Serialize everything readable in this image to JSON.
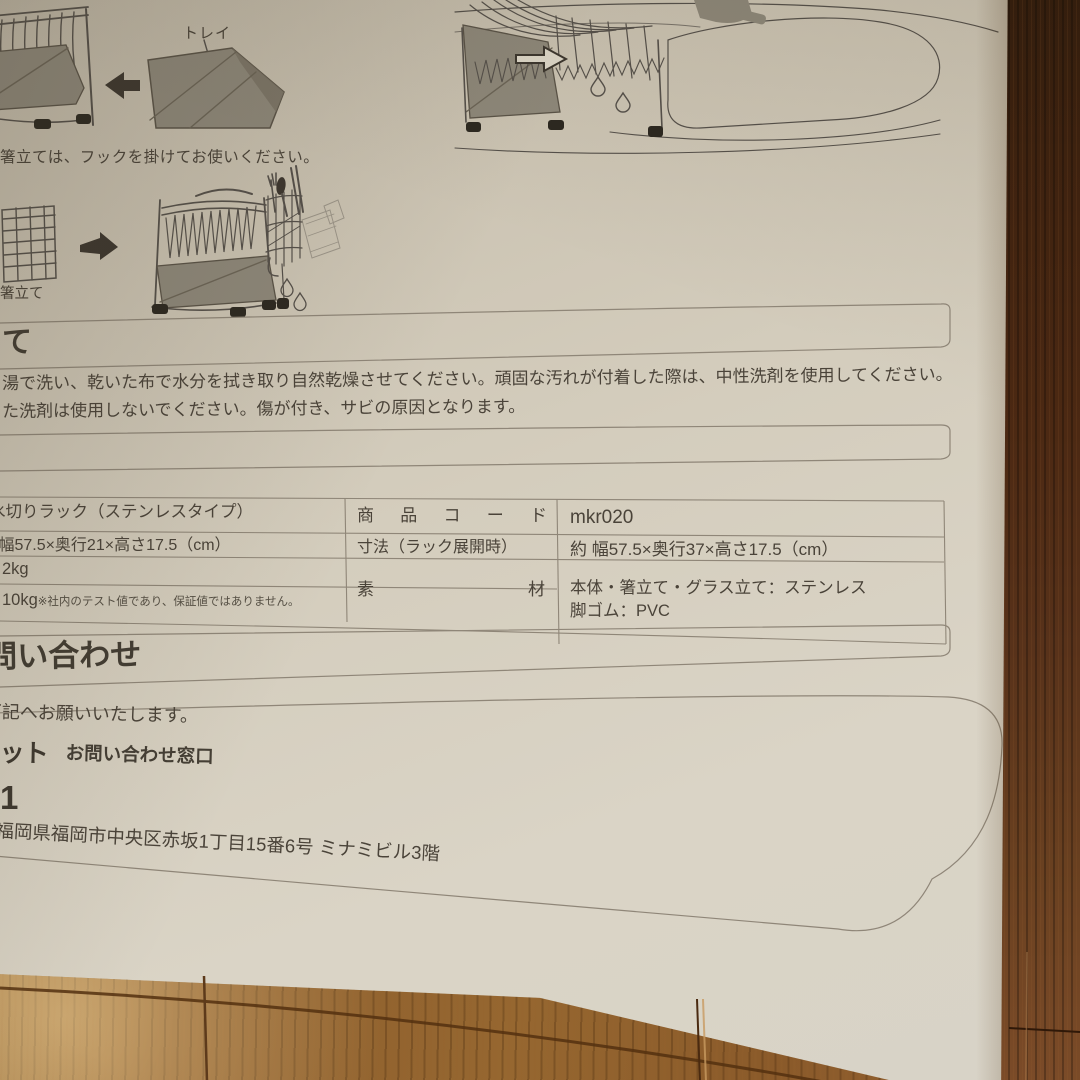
{
  "document": {
    "diagrams": {
      "tray_label": "トレイ",
      "hook_caption": "箸立ては、フックを掛けてお使いください。",
      "hashitate_label": "箸立て"
    },
    "care_section": {
      "heading_fragment": "て",
      "line1": "湯で洗い、乾いた布で水分を拭き取り自然乾燥させてください。頑固な汚れが付着した際は、中性洗剤を使用してください。",
      "line2": "た洗剤は使用しないでください。傷が付き、サビの原因となります。"
    },
    "spec_table": {
      "product_name": "水切りラック（ステンレスタイプ）",
      "code_label": "商品コード",
      "code_value": "mkr020",
      "size_folded": "約 幅57.5×奥行21×高さ17.5（cm）",
      "size_label": "寸法（ラック展開時）",
      "size_expanded": "約 幅57.5×奥行37×高さ17.5（cm）",
      "weight": "2kg",
      "load": "10kg",
      "load_note": "※社内のテスト値であり、保証値ではありません。",
      "material_label": "素材",
      "material_line1": "本体・箸立て・グラス立て：ステンレス",
      "material_line2": "脚ゴム：PVC"
    },
    "contact_section": {
      "heading": "お問い合わせ",
      "intro": "下記へお願いいたします。",
      "logo_fragment": "ット",
      "window_label": "お問い合わせ窓口",
      "phone_fragment": "1",
      "address": "福岡県福岡市中央区赤坂1丁目15番6号 ミナミビル3階"
    }
  },
  "colors": {
    "paper": "#d4cdbd",
    "ink": "#4a4339",
    "rule_line": "#8f8678",
    "diagram_gray": "#8e887a",
    "wood_floor": "#96662f",
    "wood_plank": "#4e2c17"
  }
}
